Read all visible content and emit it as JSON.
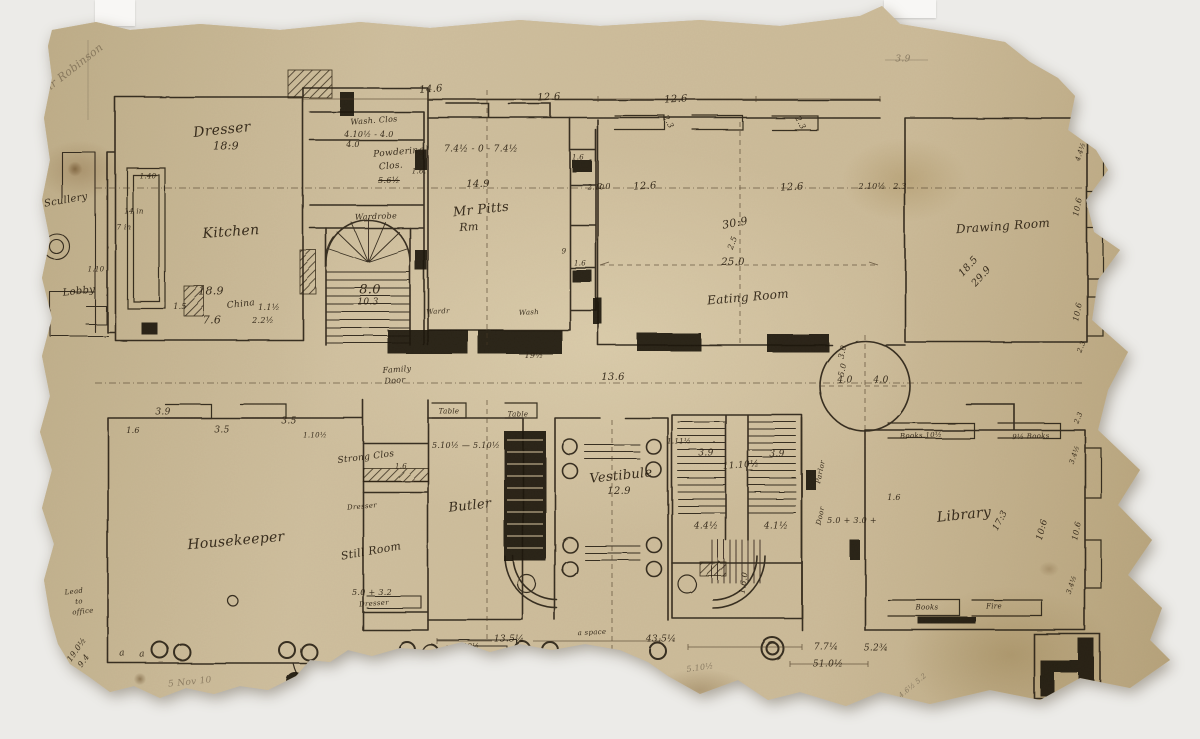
{
  "document": {
    "description": "Hand-drawn ink floor plan sketch on torn aged paper",
    "inscription_top_left": "Sir Robinson"
  },
  "colors": {
    "paper": "#c9b795",
    "ink": "#2c2114",
    "pencil": "#8d7f66",
    "background": "#ecebe8"
  },
  "rooms": [
    {
      "name": "Kitchen",
      "dimension": "18.9 x 7.6"
    },
    {
      "name": "Dresser",
      "dimension": "18:9"
    },
    {
      "name": "Wash. Clos"
    },
    {
      "name": "Powdering Clos."
    },
    {
      "name": "Wardrobe"
    },
    {
      "name": "Great Stair",
      "dimension": "8.0 / 10.3"
    },
    {
      "name": "Mr Pitts Rm",
      "dimension": "14.9 / 7.4½ - 7.4½"
    },
    {
      "name": "Eating Room",
      "dimension": "30:9 x 25.0"
    },
    {
      "name": "Drawing Room",
      "dimension": "29.9 x 18.5"
    },
    {
      "name": "Scullery"
    },
    {
      "name": "Lobby"
    },
    {
      "name": "Housekeeper"
    },
    {
      "name": "Strong Clos"
    },
    {
      "name": "Still Room",
      "dimension": "5.0 + 3.2"
    },
    {
      "name": "Butler",
      "dimension": "5.10½ - 5.10½"
    },
    {
      "name": "Vestibule",
      "dimension": "12.9"
    },
    {
      "name": "Back Stairs",
      "dimension": "11.10½ / 3.9 / 3.9"
    },
    {
      "name": "Library",
      "dimension": "17:3 x 10:6"
    }
  ],
  "plan": {
    "labels": [
      {
        "t": "Dresser",
        "x": 222,
        "y": 130,
        "s": 14,
        "r": -6
      },
      {
        "t": "18:9",
        "x": 226,
        "y": 146,
        "s": 11
      },
      {
        "t": "Kitchen",
        "x": 231,
        "y": 232,
        "s": 14,
        "r": -4
      },
      {
        "t": "1.40",
        "x": 148,
        "y": 177,
        "s": 7
      },
      {
        "t": "14 in",
        "x": 134,
        "y": 212,
        "s": 7
      },
      {
        "t": "7 in",
        "x": 124,
        "y": 228,
        "s": 7
      },
      {
        "t": "18.9",
        "x": 211,
        "y": 291,
        "s": 11
      },
      {
        "t": "1.5",
        "x": 180,
        "y": 307,
        "s": 8
      },
      {
        "t": "China",
        "x": 241,
        "y": 305,
        "s": 9,
        "r": -6
      },
      {
        "t": "1.1½",
        "x": 269,
        "y": 308,
        "s": 8
      },
      {
        "t": "7.6",
        "x": 212,
        "y": 320,
        "s": 11
      },
      {
        "t": "2.2½",
        "x": 263,
        "y": 321,
        "s": 8
      },
      {
        "t": "Wash. Clos",
        "x": 374,
        "y": 121,
        "s": 8,
        "r": -4
      },
      {
        "t": "4.10½ - 4.0",
        "x": 369,
        "y": 135,
        "s": 8
      },
      {
        "t": "4.0",
        "x": 353,
        "y": 145,
        "s": 8
      },
      {
        "t": "Powdering",
        "x": 399,
        "y": 153,
        "s": 9,
        "r": -5
      },
      {
        "t": "Clos.",
        "x": 391,
        "y": 167,
        "s": 9,
        "r": -5
      },
      {
        "t": "5.6½",
        "x": 389,
        "y": 181,
        "s": 8,
        "k": "strike"
      },
      {
        "t": "Wardrobe",
        "x": 376,
        "y": 217,
        "s": 8,
        "r": -2
      },
      {
        "t": "1.6.",
        "x": 419,
        "y": 172,
        "s": 7
      },
      {
        "t": "8.0",
        "x": 370,
        "y": 290,
        "s": 13
      },
      {
        "t": "10.3",
        "x": 368,
        "y": 303,
        "s": 9
      },
      {
        "t": "14.6",
        "x": 431,
        "y": 90,
        "s": 10,
        "r": -4
      },
      {
        "t": "12.6",
        "x": 549,
        "y": 98,
        "s": 10,
        "r": -3
      },
      {
        "t": "12.6",
        "x": 676,
        "y": 100,
        "s": 10,
        "r": -3
      },
      {
        "t": "2.3",
        "x": 668,
        "y": 122,
        "s": 8,
        "r": 62
      },
      {
        "t": "2.3",
        "x": 800,
        "y": 123,
        "s": 8,
        "r": 62
      },
      {
        "t": "7.4½ - 0 - 7.4½",
        "x": 481,
        "y": 150,
        "s": 9
      },
      {
        "t": "14.9",
        "x": 478,
        "y": 185,
        "s": 10
      },
      {
        "t": "Mr Pitts",
        "x": 481,
        "y": 210,
        "s": 13,
        "r": -6
      },
      {
        "t": "Rm",
        "x": 469,
        "y": 227,
        "s": 11,
        "r": -4
      },
      {
        "t": "1.6",
        "x": 578,
        "y": 158,
        "s": 7
      },
      {
        "t": "2.10",
        "x": 596,
        "y": 188,
        "s": 7
      },
      {
        "t": "1.6",
        "x": 580,
        "y": 264,
        "s": 7
      },
      {
        "t": "9",
        "x": 564,
        "y": 252,
        "s": 7
      },
      {
        "t": "Wardr",
        "x": 438,
        "y": 312,
        "s": 7,
        "r": -3
      },
      {
        "t": "Wash",
        "x": 529,
        "y": 313,
        "s": 7,
        "r": -3
      },
      {
        "t": "2.0",
        "x": 604,
        "y": 187,
        "s": 8
      },
      {
        "t": "12.6",
        "x": 645,
        "y": 187,
        "s": 10,
        "r": -3
      },
      {
        "t": "12.6",
        "x": 792,
        "y": 188,
        "s": 10,
        "r": -3
      },
      {
        "t": "2.10½",
        "x": 872,
        "y": 187,
        "s": 8
      },
      {
        "t": "2.3",
        "x": 900,
        "y": 187,
        "s": 8
      },
      {
        "t": "30:9",
        "x": 735,
        "y": 223,
        "s": 11,
        "r": -10
      },
      {
        "t": "2.5",
        "x": 733,
        "y": 243,
        "s": 8,
        "r": -70
      },
      {
        "t": "25.0",
        "x": 733,
        "y": 263,
        "s": 10
      },
      {
        "t": "Eating Room",
        "x": 748,
        "y": 297,
        "s": 12,
        "r": -5
      },
      {
        "t": "Drawing Room",
        "x": 1003,
        "y": 226,
        "s": 12,
        "r": -4
      },
      {
        "t": "18.5",
        "x": 969,
        "y": 267,
        "s": 10,
        "r": -48
      },
      {
        "t": "29.9",
        "x": 982,
        "y": 277,
        "s": 10,
        "r": -48
      },
      {
        "t": "2.3",
        "x": 1078,
        "y": 116,
        "s": 7,
        "r": -68
      },
      {
        "t": "4.4½",
        "x": 1081,
        "y": 152,
        "s": 7,
        "r": -72
      },
      {
        "t": "10.6",
        "x": 1078,
        "y": 207,
        "s": 8,
        "r": -78
      },
      {
        "t": "2+3",
        "x": 1100,
        "y": 213,
        "s": 8
      },
      {
        "t": "10.6",
        "x": 1078,
        "y": 312,
        "s": 8,
        "r": -78
      },
      {
        "t": "4.3",
        "x": 1139,
        "y": 199,
        "s": 8,
        "r": -55
      },
      {
        "t": "2.3",
        "x": 1082,
        "y": 347,
        "s": 7,
        "r": -68
      },
      {
        "t": "3.9",
        "x": 903,
        "y": 60,
        "s": 9,
        "k": "pencil"
      },
      {
        "t": "16",
        "x": 1143,
        "y": 57,
        "s": 9,
        "k": "pencil"
      },
      {
        "t": "Sir Robinson",
        "x": 72,
        "y": 69,
        "s": 11,
        "r": -38,
        "k": "faint"
      },
      {
        "t": "Scullery",
        "x": 66,
        "y": 201,
        "s": 10,
        "r": -10
      },
      {
        "t": "Lobby",
        "x": 79,
        "y": 292,
        "s": 10,
        "r": -6
      },
      {
        "t": "1.10",
        "x": 96,
        "y": 270,
        "s": 7
      },
      {
        "t": "4.0",
        "x": 845,
        "y": 381,
        "s": 9
      },
      {
        "t": "4.0",
        "x": 881,
        "y": 381,
        "s": 9
      },
      {
        "t": "3.0",
        "x": 843,
        "y": 352,
        "s": 8,
        "r": -78
      },
      {
        "t": "5.0",
        "x": 843,
        "y": 370,
        "s": 8,
        "r": -78
      },
      {
        "t": "Family",
        "x": 397,
        "y": 370,
        "s": 8,
        "r": -4
      },
      {
        "t": "Door",
        "x": 395,
        "y": 381,
        "s": 8,
        "r": -4
      },
      {
        "t": "19½",
        "x": 534,
        "y": 356,
        "s": 8
      },
      {
        "t": "13.6",
        "x": 613,
        "y": 378,
        "s": 10
      },
      {
        "t": "10.9",
        "x": 1136,
        "y": 348,
        "s": 8,
        "r": -10
      },
      {
        "t": "10.3",
        "x": 1135,
        "y": 357,
        "s": 8,
        "r": -10
      },
      {
        "t": "16.5",
        "x": 1134,
        "y": 366,
        "s": 8,
        "r": -10
      },
      {
        "t": "2.3",
        "x": 1131,
        "y": 376,
        "s": 8,
        "r": -10
      },
      {
        "t": "2.4½",
        "x": 1132,
        "y": 385,
        "s": 8,
        "r": -10
      },
      {
        "t": "2.3",
        "x": 1130,
        "y": 394,
        "s": 8,
        "r": -10
      },
      {
        "t": "51.1",
        "x": 1131,
        "y": 406,
        "s": 8,
        "r": -10
      },
      {
        "t": "3.9",
        "x": 163,
        "y": 413,
        "s": 9
      },
      {
        "t": "3.5",
        "x": 222,
        "y": 431,
        "s": 9
      },
      {
        "t": "3.5",
        "x": 289,
        "y": 422,
        "s": 9
      },
      {
        "t": "1.10½",
        "x": 315,
        "y": 436,
        "s": 7
      },
      {
        "t": "1.6",
        "x": 133,
        "y": 431,
        "s": 8
      },
      {
        "t": "Housekeeper",
        "x": 236,
        "y": 541,
        "s": 14,
        "r": -5
      },
      {
        "t": "Strong Clos",
        "x": 366,
        "y": 458,
        "s": 9,
        "r": -7
      },
      {
        "t": "1.6",
        "x": 401,
        "y": 467,
        "s": 7
      },
      {
        "t": "Dresser",
        "x": 362,
        "y": 507,
        "s": 7,
        "r": -5
      },
      {
        "t": "Still Room",
        "x": 371,
        "y": 551,
        "s": 11,
        "r": -10
      },
      {
        "t": "5.0 + 3.2",
        "x": 372,
        "y": 593,
        "s": 8
      },
      {
        "t": "Dresser",
        "x": 374,
        "y": 604,
        "s": 7,
        "r": -4
      },
      {
        "t": "Table",
        "x": 449,
        "y": 412,
        "s": 7
      },
      {
        "t": "Table",
        "x": 518,
        "y": 415,
        "s": 7
      },
      {
        "t": "5.10½ — 5.10½",
        "x": 466,
        "y": 446,
        "s": 8
      },
      {
        "t": "Butler",
        "x": 470,
        "y": 506,
        "s": 13,
        "r": -6
      },
      {
        "t": "1.11½",
        "x": 679,
        "y": 442,
        "s": 7
      },
      {
        "t": "Vestibule",
        "x": 621,
        "y": 476,
        "s": 13,
        "r": -6
      },
      {
        "t": "12.9",
        "x": 619,
        "y": 492,
        "s": 10
      },
      {
        "t": "3.9",
        "x": 706,
        "y": 454,
        "s": 9
      },
      {
        "t": "3.9",
        "x": 777,
        "y": 455,
        "s": 9
      },
      {
        "t": "11.10½",
        "x": 741,
        "y": 466,
        "s": 9,
        "r": -4
      },
      {
        "t": "4.4½",
        "x": 706,
        "y": 527,
        "s": 9
      },
      {
        "t": "4.1½",
        "x": 776,
        "y": 527,
        "s": 9
      },
      {
        "t": "1.6.0",
        "x": 744,
        "y": 583,
        "s": 8,
        "r": -82
      },
      {
        "t": "Parlor",
        "x": 821,
        "y": 472,
        "s": 7,
        "r": -78
      },
      {
        "t": "Door",
        "x": 821,
        "y": 516,
        "s": 7,
        "r": -78
      },
      {
        "t": "5.0 + 3.0 +",
        "x": 852,
        "y": 521,
        "s": 8
      },
      {
        "t": "Library",
        "x": 964,
        "y": 515,
        "s": 14,
        "r": -6
      },
      {
        "t": "1.6",
        "x": 894,
        "y": 498,
        "s": 8
      },
      {
        "t": "17:3",
        "x": 1001,
        "y": 521,
        "s": 9,
        "r": -62
      },
      {
        "t": "10:6",
        "x": 1043,
        "y": 530,
        "s": 9,
        "r": -75
      },
      {
        "t": "Books 10½",
        "x": 921,
        "y": 436,
        "s": 7,
        "r": -2
      },
      {
        "t": "9½ Books",
        "x": 1031,
        "y": 437,
        "s": 7,
        "r": -2
      },
      {
        "t": "2.3",
        "x": 1079,
        "y": 418,
        "s": 7,
        "r": -68
      },
      {
        "t": "3.4½",
        "x": 1075,
        "y": 455,
        "s": 7,
        "r": -72
      },
      {
        "t": "10.6",
        "x": 1077,
        "y": 531,
        "s": 8,
        "r": -78
      },
      {
        "t": "3.4½",
        "x": 1072,
        "y": 585,
        "s": 7,
        "r": -72
      },
      {
        "t": "Books",
        "x": 927,
        "y": 608,
        "s": 7
      },
      {
        "t": "Fire",
        "x": 994,
        "y": 607,
        "s": 7
      },
      {
        "t": "13.5¼",
        "x": 509,
        "y": 640,
        "s": 9
      },
      {
        "t": "a space",
        "x": 592,
        "y": 633,
        "s": 7,
        "r": -3
      },
      {
        "t": "43.5¼",
        "x": 661,
        "y": 640,
        "s": 9
      },
      {
        "t": "19½",
        "x": 471,
        "y": 647,
        "s": 7
      },
      {
        "t": "6",
        "x": 473,
        "y": 657,
        "s": 7
      },
      {
        "t": "7.7¼",
        "x": 826,
        "y": 648,
        "s": 9
      },
      {
        "t": "5.2¾",
        "x": 876,
        "y": 649,
        "s": 9
      },
      {
        "t": "51.0½",
        "x": 828,
        "y": 665,
        "s": 9
      },
      {
        "t": "a",
        "x": 122,
        "y": 654,
        "s": 9,
        "r": -6
      },
      {
        "t": "a",
        "x": 142,
        "y": 655,
        "s": 9,
        "r": -6
      },
      {
        "t": "5 Nov 10",
        "x": 190,
        "y": 683,
        "s": 9,
        "r": -6,
        "k": "faint"
      },
      {
        "t": "Lead",
        "x": 74,
        "y": 592,
        "s": 7,
        "r": -6
      },
      {
        "t": "to",
        "x": 79,
        "y": 602,
        "s": 7,
        "r": -6
      },
      {
        "t": "office",
        "x": 83,
        "y": 612,
        "s": 7,
        "r": -6
      },
      {
        "t": "19.0½",
        "x": 77,
        "y": 650,
        "s": 8,
        "r": -55
      },
      {
        "t": "9.4",
        "x": 84,
        "y": 661,
        "s": 8,
        "r": -55
      },
      {
        "t": "5.10½",
        "x": 700,
        "y": 668,
        "s": 8,
        "r": -8,
        "k": "pencil"
      },
      {
        "t": "4.6½ 5.2",
        "x": 913,
        "y": 686,
        "s": 7,
        "r": -40,
        "k": "pencil"
      }
    ]
  }
}
